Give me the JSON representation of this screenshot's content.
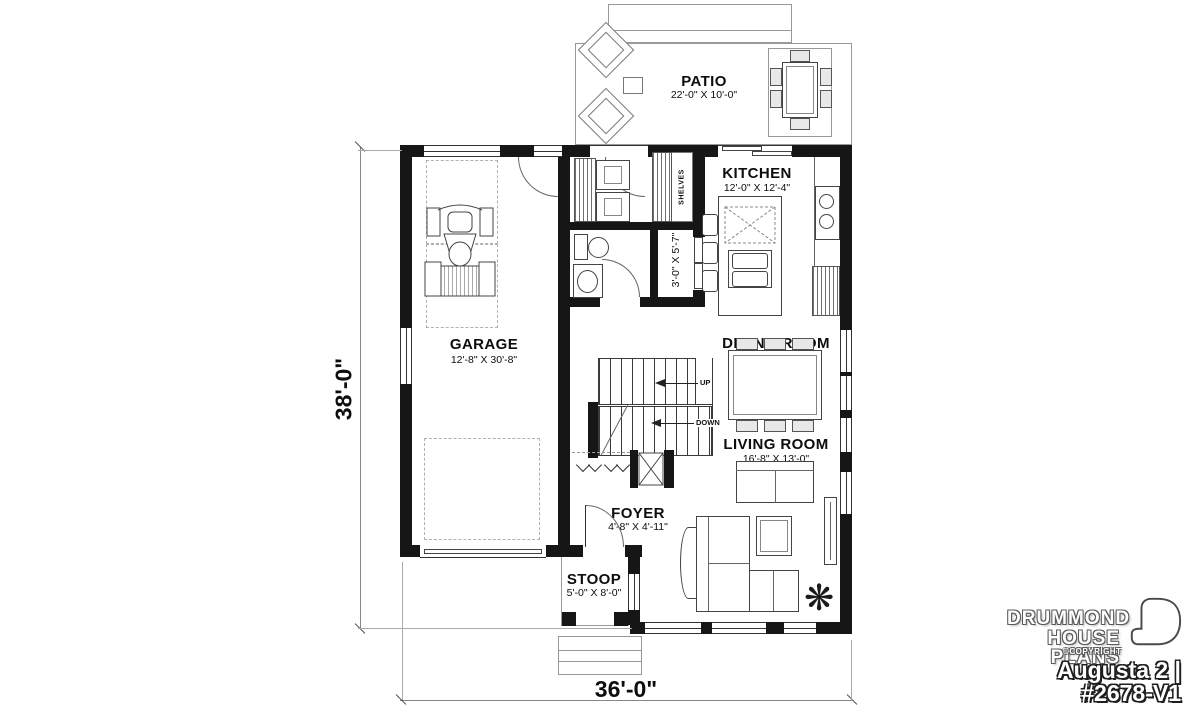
{
  "rooms": {
    "patio": {
      "name": "PATIO",
      "dims": "22'-0\" X 10'-0\""
    },
    "kitchen": {
      "name": "KITCHEN",
      "dims": "12'-0\" X 12'-4\""
    },
    "garage": {
      "name": "GARAGE",
      "dims": "12'-8\" X 30'-8\""
    },
    "dining_room": {
      "name": "DINING ROOM",
      "dims": "12'-0\" X 10'-9\""
    },
    "living_room": {
      "name": "LIVING ROOM",
      "dims": "16'-8\" X 13'-0\""
    },
    "foyer": {
      "name": "FOYER",
      "dims": "4'-8\" X 4'-11\""
    },
    "stoop": {
      "name": "STOOP",
      "dims": "5'-0\" X 8'-0\""
    },
    "closet": {
      "dims": "3'-0\" X 5'-7\""
    }
  },
  "annotations": {
    "shelves": "SHELVES",
    "stairs_up": "UP",
    "stairs_down": "DOWN"
  },
  "overall_dimensions": {
    "width": "36'-0\"",
    "depth": "38'-0\""
  },
  "branding": {
    "company_line1": "DRUMMOND",
    "company_line2": "HOUSE PLANS",
    "copyright": "©COPYRIGHT",
    "plan_title": "Augusta 2 | #2678-V1"
  },
  "icons": {
    "plant": "❋"
  },
  "colors": {
    "wall": "#161616",
    "line": "#555555",
    "background": "#ffffff"
  }
}
